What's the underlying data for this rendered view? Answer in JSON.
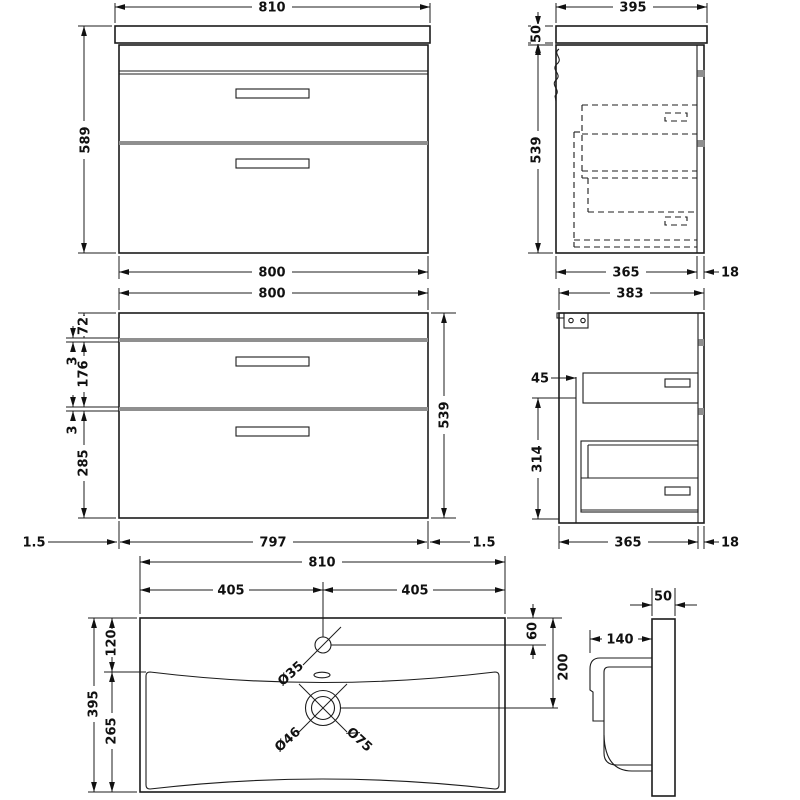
{
  "document": {
    "type": "technical-drawing"
  },
  "views": {
    "front": {
      "width_top": "810",
      "height_overall": "589",
      "width_base": "800"
    },
    "side": {
      "depth_top": "395",
      "worktop_height": "50",
      "cabinet_height": "539",
      "cabinet_depth": "365",
      "front_thickness": "18"
    },
    "front_detail": {
      "width_top": "800",
      "top_rail": "72",
      "gap_upper": "3",
      "drawer_upper": "176",
      "gap_lower": "3",
      "drawer_lower": "285",
      "cabinet_height": "539",
      "edge_left": "1.5",
      "width_inner": "797",
      "edge_right": "1.5"
    },
    "side_detail": {
      "depth_top": "383",
      "back_gap": "45",
      "inner_height": "314",
      "cabinet_depth": "365",
      "front_thickness": "18"
    },
    "basin_plan": {
      "width": "810",
      "half_left": "405",
      "half_right": "405",
      "depth": "395",
      "rim_front": "120",
      "bowl_depth": "265",
      "tap_offset": "60",
      "waste_offset": "200",
      "tap_hole": "Ø35",
      "waste_inner": "Ø46",
      "waste_outer": "Ø75"
    },
    "basin_side": {
      "rim_thickness": "50",
      "bowl_projection": "140"
    }
  }
}
